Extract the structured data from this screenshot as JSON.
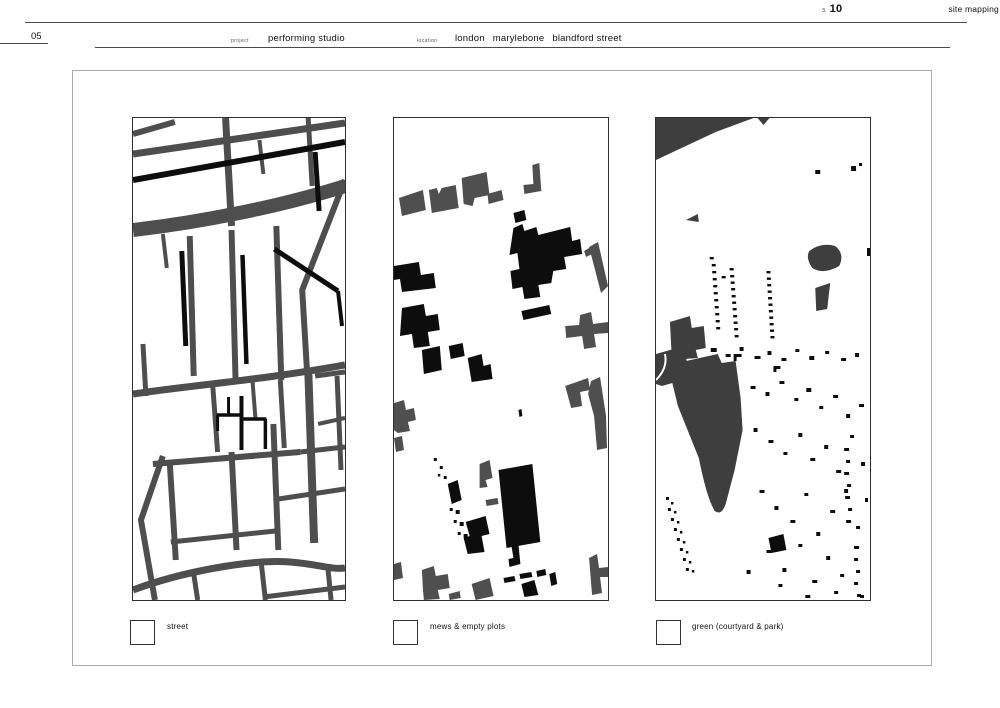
{
  "page": {
    "number_left": "05",
    "section_ref": "3.",
    "page_ref": "10",
    "title": "site mapping"
  },
  "project": {
    "label": "project",
    "value": "performing studio"
  },
  "location": {
    "label": "location",
    "city": "london",
    "district": "marylebone",
    "street": "blandford street"
  },
  "figures": [
    {
      "id": "street-map",
      "legend": "street"
    },
    {
      "id": "mews-map",
      "legend": "mews & empty plots"
    },
    {
      "id": "green-map",
      "legend": "green (courtyard & park)"
    }
  ],
  "colors": {
    "street_gray": "#4e4e4e",
    "ink_black": "#0d0d0d",
    "park_gray": "#3e3e3e",
    "frame_border": "#ababab",
    "panel_border": "#2e2e2e",
    "rule_gray": "#4a4a4a"
  }
}
